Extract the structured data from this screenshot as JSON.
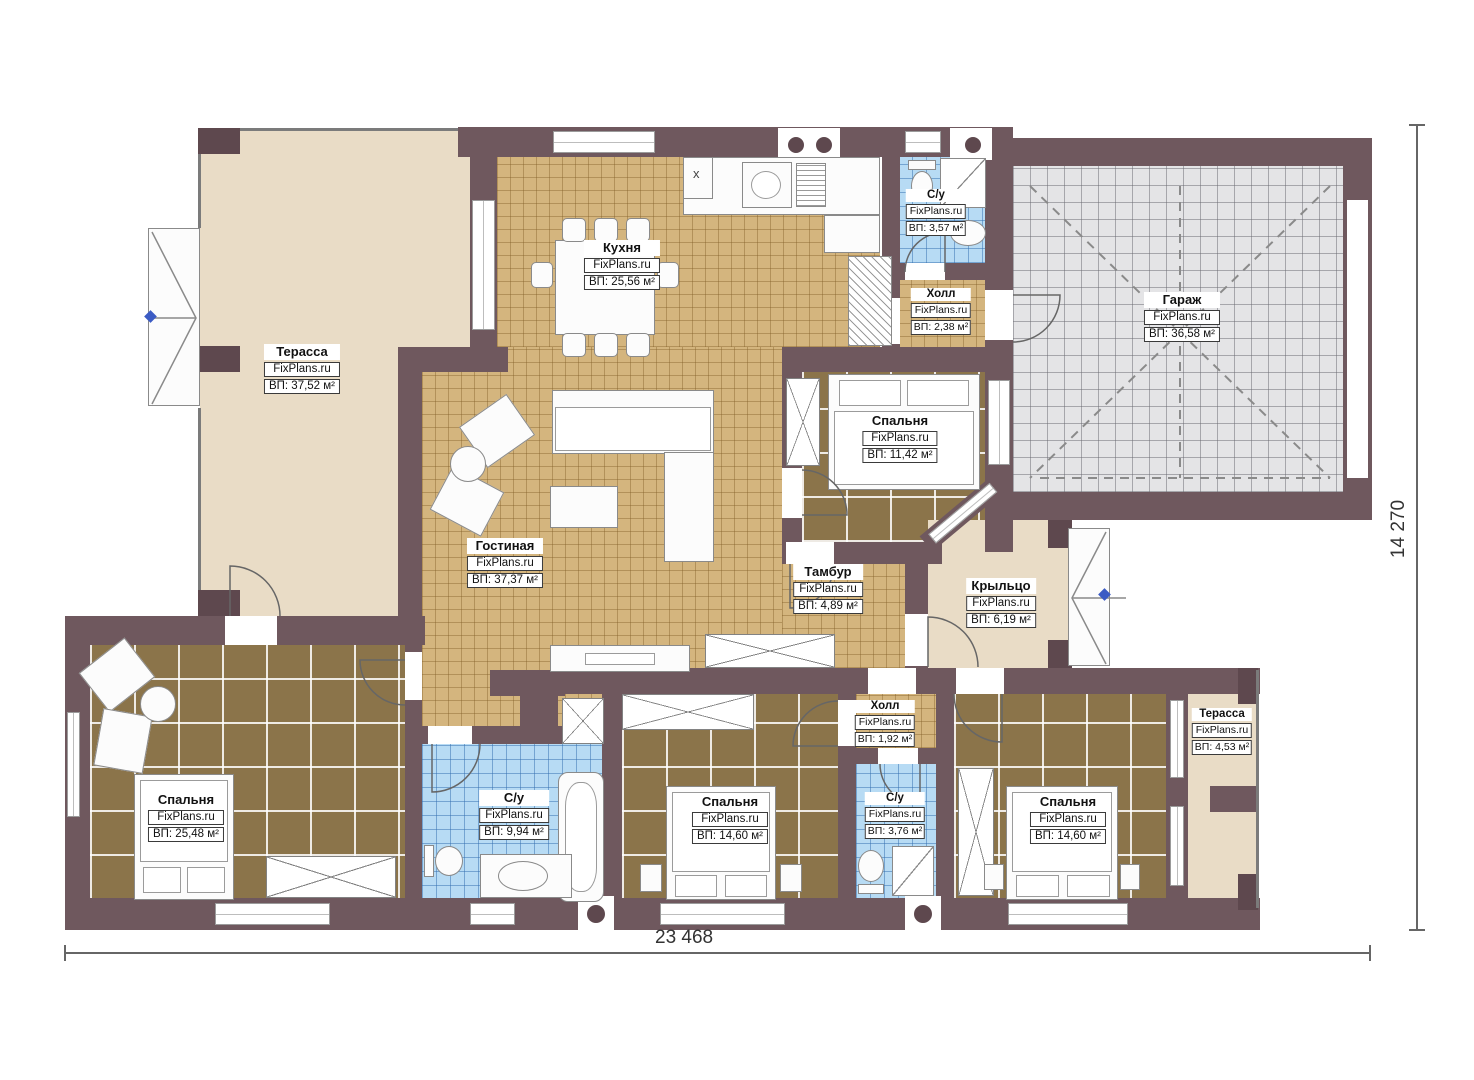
{
  "watermark": "FixPlans.ru",
  "dimensions": {
    "width_label": "23 468",
    "height_label": "14 270"
  },
  "annotations": {
    "kitchen_cabinet_mark": "x"
  },
  "rooms": [
    {
      "id": "terrace-top",
      "name": "Терасса",
      "area": "ВП: 37,52 м²"
    },
    {
      "id": "kitchen",
      "name": "Кухня",
      "area": "ВП: 25,56 м²"
    },
    {
      "id": "bathroom-top",
      "name": "С/у",
      "area": "ВП: 3,57 м²"
    },
    {
      "id": "hall-top",
      "name": "Холл",
      "area": "ВП: 2,38 м²"
    },
    {
      "id": "garage",
      "name": "Гараж",
      "area": "ВП: 36,58 м²"
    },
    {
      "id": "bedroom-middle",
      "name": "Спальня",
      "area": "ВП: 11,42 м²"
    },
    {
      "id": "living-room",
      "name": "Гостиная",
      "area": "ВП: 37,37 м²"
    },
    {
      "id": "vestibule",
      "name": "Тамбур",
      "area": "ВП: 4,89 м²"
    },
    {
      "id": "porch",
      "name": "Крыльцо",
      "area": "ВП: 6,19 м²"
    },
    {
      "id": "bedroom-left",
      "name": "Спальня",
      "area": "ВП: 25,48 м²"
    },
    {
      "id": "bathroom-main",
      "name": "С/у",
      "area": "ВП: 9,94 м²"
    },
    {
      "id": "bedroom-center",
      "name": "Спальня",
      "area": "ВП: 14,60 м²"
    },
    {
      "id": "hall-bottom",
      "name": "Холл",
      "area": "ВП: 1,92 м²"
    },
    {
      "id": "bathroom-bottom",
      "name": "С/у",
      "area": "ВП: 3,76 м²"
    },
    {
      "id": "bedroom-right",
      "name": "Спальня",
      "area": "ВП: 14,60 м²"
    },
    {
      "id": "terrace-bottom",
      "name": "Терасса",
      "area": "ВП: 4,53 м²"
    }
  ],
  "colors": {
    "wall": "#6f585e",
    "wall-dark": "#5e484e",
    "floor-tile": "#d4b57e",
    "floor-carpet": "#8b744a",
    "floor-bath": "#b7dbf4",
    "floor-garage": "#e4e4e6",
    "floor-terrace": "#e9dcc6",
    "accent-marker": "#3b5bc4"
  }
}
